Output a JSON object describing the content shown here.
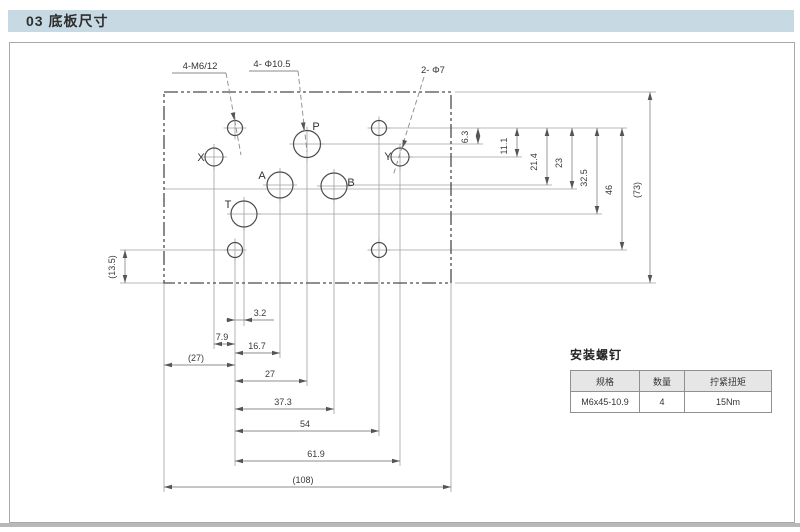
{
  "header": {
    "title": "03 底板尺寸"
  },
  "colors": {
    "header_bar": "#c7dae3",
    "panel_border": "#a9a9a9",
    "footer_bar": "#b8b8b8",
    "outline": "#4c4c4c",
    "extension_line": "#a0a0a0",
    "dimension_line": "#8e8e8e",
    "table_header_bg": "#e6e6e6"
  },
  "table": {
    "title": "安装螺钉",
    "columns": [
      "规格",
      "数量",
      "拧紧扭矩"
    ],
    "rows": [
      [
        "M6x45-10.9",
        "4",
        "15Nm"
      ]
    ]
  },
  "drawing": {
    "plate": {
      "x1": 164,
      "y1": 92,
      "x2": 451,
      "y2": 283
    },
    "holes": [
      {
        "name": "mount-hole-top-left",
        "cx": 235,
        "cy": 128,
        "r": 7.5
      },
      {
        "name": "mount-hole-top-right",
        "cx": 379,
        "cy": 128,
        "r": 7.5
      },
      {
        "name": "mount-hole-bot-left",
        "cx": 235,
        "cy": 250,
        "r": 7.5
      },
      {
        "name": "mount-hole-bot-right",
        "cx": 379,
        "cy": 250,
        "r": 7.5
      },
      {
        "name": "port-X",
        "cx": 214,
        "cy": 157,
        "r": 9,
        "label": "X",
        "lx": 201,
        "ly": 161
      },
      {
        "name": "port-Y",
        "cx": 400,
        "cy": 157,
        "r": 9,
        "label": "Y",
        "lx": 388,
        "ly": 160
      },
      {
        "name": "port-P",
        "cx": 307,
        "cy": 144,
        "r": 13.5,
        "label": "P",
        "lx": 316,
        "ly": 130
      },
      {
        "name": "port-A",
        "cx": 280,
        "cy": 185,
        "r": 13,
        "label": "A",
        "lx": 262,
        "ly": 179
      },
      {
        "name": "port-B",
        "cx": 334,
        "cy": 186,
        "r": 13,
        "label": "B",
        "lx": 351,
        "ly": 186
      },
      {
        "name": "port-T",
        "cx": 244,
        "cy": 214,
        "r": 13,
        "label": "T",
        "lx": 228,
        "ly": 208
      }
    ],
    "callouts": [
      {
        "t": "4-M6/12",
        "tx": 200,
        "ty": 69,
        "ul": [
          172,
          73,
          226,
          73
        ],
        "leader": [
          226,
          73,
          241,
          155
        ],
        "arrow": [
          234.5,
          120.5,
          79
        ]
      },
      {
        "t": "4- Φ10.5",
        "tx": 272,
        "ty": 67,
        "ul": [
          249,
          71,
          298,
          71
        ],
        "leader": [
          298,
          71,
          307,
          152
        ],
        "arrow": [
          304,
          130.5,
          84
        ]
      },
      {
        "t": "2- Φ7",
        "tx": 433,
        "ty": 73,
        "ul": null,
        "leader": [
          424,
          77,
          393,
          176
        ],
        "arrow": [
          402.5,
          148,
          107
        ]
      }
    ],
    "ext": [
      [
        386,
        128,
        627,
        128
      ],
      [
        320,
        144,
        483,
        144
      ],
      [
        409,
        157,
        522,
        157
      ],
      [
        347,
        185,
        552,
        185
      ],
      [
        164,
        189,
        577,
        189
      ],
      [
        257,
        214,
        602,
        214
      ],
      [
        386,
        250,
        627,
        250
      ],
      [
        120,
        250,
        243,
        250
      ],
      [
        455,
        92,
        656,
        92
      ],
      [
        455,
        283,
        656,
        283
      ],
      [
        120,
        283,
        164,
        283
      ],
      [
        214,
        166,
        214,
        349
      ],
      [
        235,
        258,
        235,
        466
      ],
      [
        244,
        227,
        244,
        326
      ],
      [
        280,
        198,
        280,
        358
      ],
      [
        307,
        157,
        307,
        386
      ],
      [
        334,
        199,
        334,
        414
      ],
      [
        379,
        136,
        379,
        436
      ],
      [
        400,
        166,
        400,
        466
      ],
      [
        164,
        283,
        164,
        492
      ],
      [
        451,
        283,
        451,
        492
      ]
    ],
    "dims_h": [
      {
        "y": 320,
        "x1": 235,
        "x2": 244,
        "t": "3.2",
        "tx": 260,
        "ty": 316,
        "outside": true,
        "tail_x": 274
      },
      {
        "y": 344,
        "x1": 214,
        "x2": 235,
        "t": "7.9",
        "tx": 222,
        "ty": 340
      },
      {
        "y": 353,
        "x1": 235,
        "x2": 280,
        "t": "16.7",
        "tx": 257,
        "ty": 349
      },
      {
        "y": 365,
        "x1": 164,
        "x2": 235,
        "t": "(27)",
        "tx": 196,
        "ty": 361
      },
      {
        "y": 381,
        "x1": 235,
        "x2": 307,
        "t": "27",
        "tx": 270,
        "ty": 377
      },
      {
        "y": 409,
        "x1": 235,
        "x2": 334,
        "t": "37.3",
        "tx": 283,
        "ty": 405
      },
      {
        "y": 431,
        "x1": 235,
        "x2": 379,
        "t": "54",
        "tx": 305,
        "ty": 427
      },
      {
        "y": 461,
        "x1": 235,
        "x2": 400,
        "t": "61.9",
        "tx": 316,
        "ty": 457
      },
      {
        "y": 487,
        "x1": 164,
        "x2": 451,
        "t": "(108)",
        "tx": 303,
        "ty": 483
      }
    ],
    "dims_v": [
      {
        "x": 478,
        "y1": 128,
        "y2": 144,
        "t": "6.3",
        "tx": 468,
        "ty": 137
      },
      {
        "x": 517,
        "y1": 128,
        "y2": 157,
        "t": "11.1",
        "tx": 507,
        "ty": 146
      },
      {
        "x": 547,
        "y1": 128,
        "y2": 185,
        "t": "21.4",
        "tx": 537,
        "ty": 162
      },
      {
        "x": 572,
        "y1": 128,
        "y2": 189,
        "t": "23",
        "tx": 562,
        "ty": 163
      },
      {
        "x": 597,
        "y1": 128,
        "y2": 214,
        "t": "32.5",
        "tx": 587,
        "ty": 178
      },
      {
        "x": 622,
        "y1": 128,
        "y2": 250,
        "t": "46",
        "tx": 612,
        "ty": 190
      },
      {
        "x": 650,
        "y1": 92,
        "y2": 283,
        "t": "(73)",
        "tx": 640,
        "ty": 190
      },
      {
        "x": 125,
        "y1": 250,
        "y2": 283,
        "t": "(13.5)",
        "tx": 115,
        "ty": 267
      }
    ]
  }
}
